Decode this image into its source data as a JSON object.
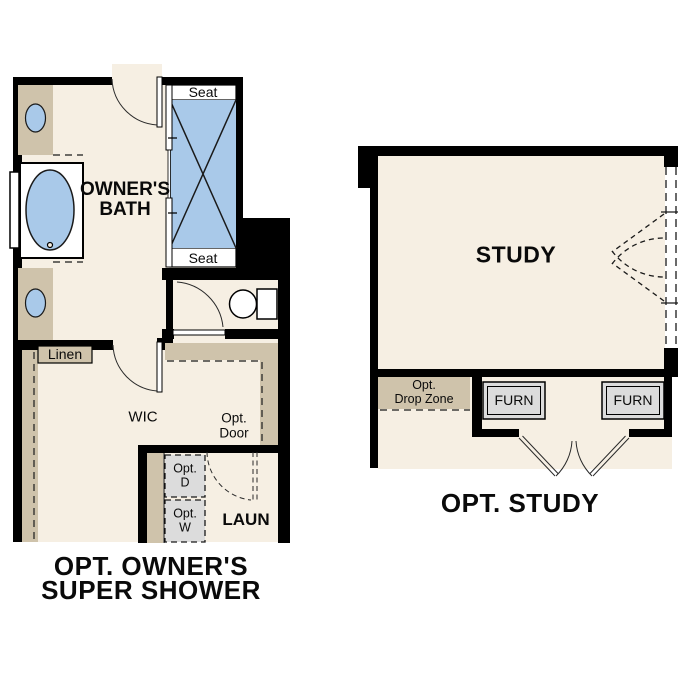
{
  "palette": {
    "wall_black": "#000000",
    "floor_cream": "#f6efe3",
    "cabinet_tan": "#cfc3ab",
    "fixture_blue": "#a9c9e9",
    "appliance_gray": "#dcdcdc",
    "background_white": "#ffffff"
  },
  "left_plan": {
    "seat_top": "Seat",
    "seat_bottom": "Seat",
    "room_line1": "OWNER'S",
    "room_line2": "BATH",
    "linen": "Linen",
    "wic": "WIC",
    "opt_door_line1": "Opt.",
    "opt_door_line2": "Door",
    "opt_dryer_line1": "Opt.",
    "opt_dryer_line2": "D",
    "opt_washer_line1": "Opt.",
    "opt_washer_line2": "W",
    "laundry": "LAUN",
    "title_line1": "OPT. OWNER'S",
    "title_line2": "SUPER SHOWER"
  },
  "right_plan": {
    "room": "STUDY",
    "drop_zone_line1": "Opt.",
    "drop_zone_line2": "Drop Zone",
    "furn_left": "FURN",
    "furn_right": "FURN",
    "title": "OPT. STUDY"
  }
}
